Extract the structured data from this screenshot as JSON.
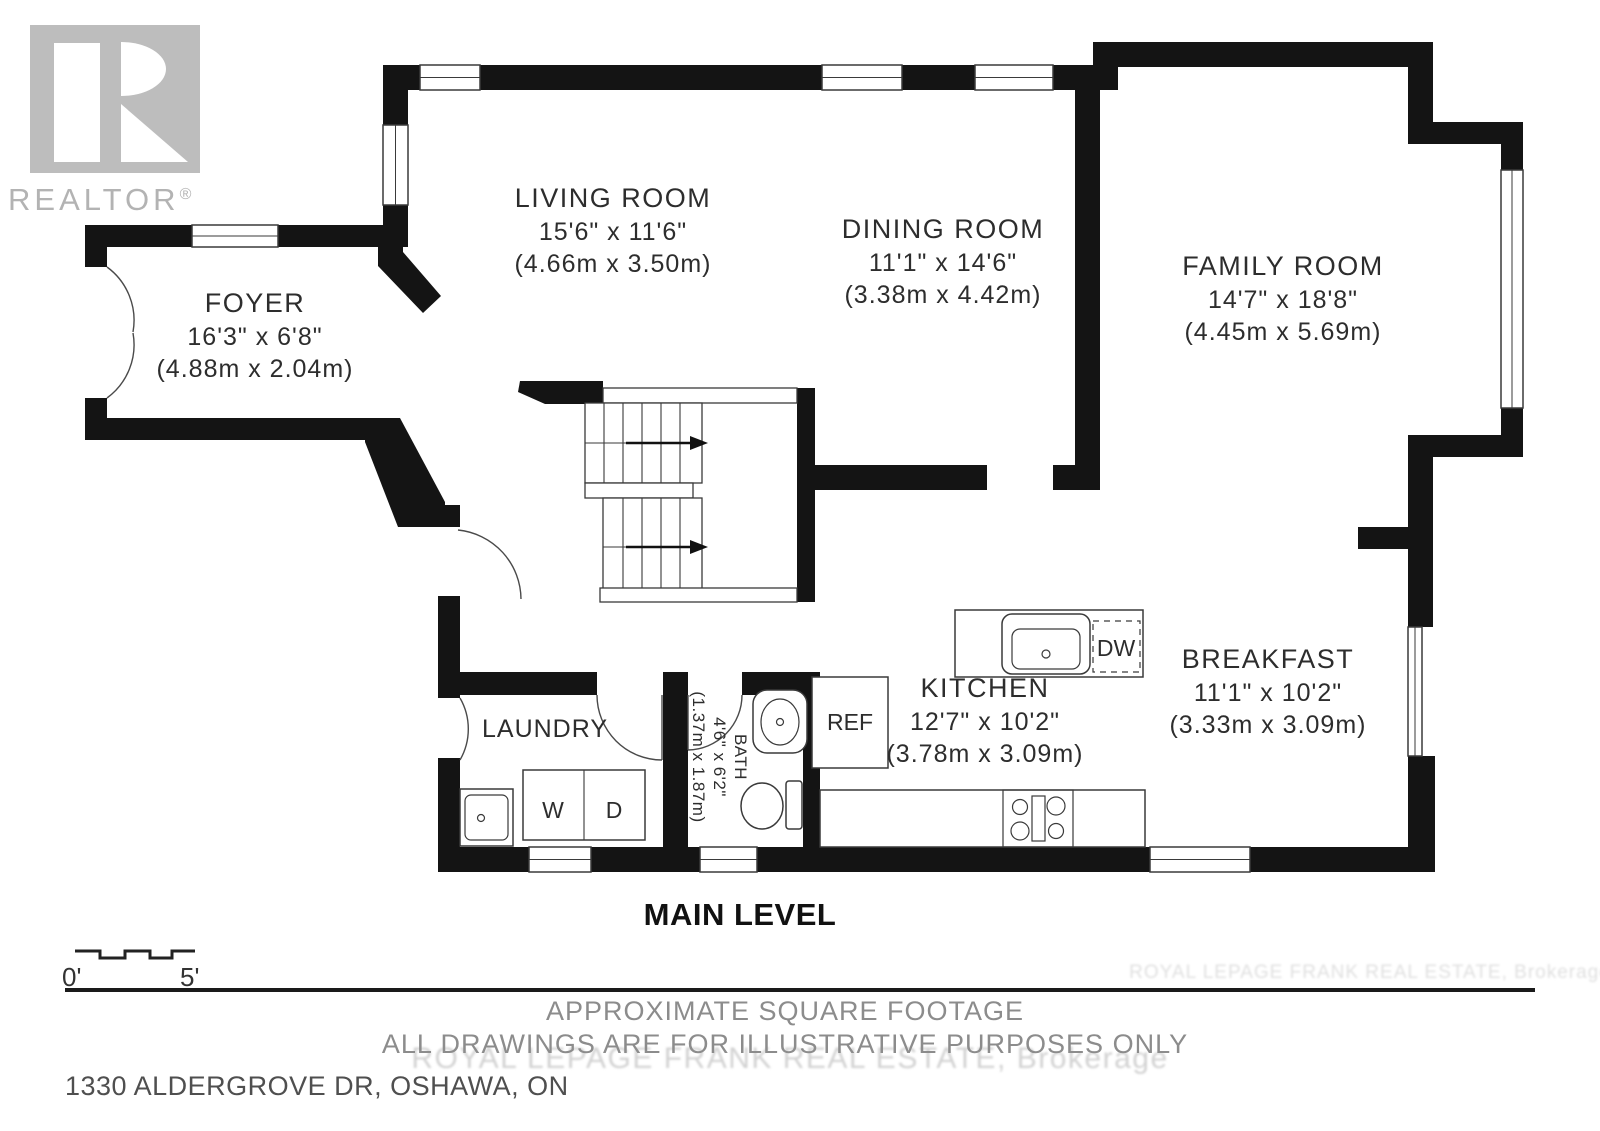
{
  "branding": {
    "realtor_wordmark": "REALTOR",
    "registered_mark": "®"
  },
  "rooms": {
    "living": {
      "name": "LIVING ROOM",
      "imperial": "15'6\" x 11'6\"",
      "metric": "(4.66m x 3.50m)"
    },
    "dining": {
      "name": "DINING ROOM",
      "imperial": "11'1\" x 14'6\"",
      "metric": "(3.38m x 4.42m)"
    },
    "family": {
      "name": "FAMILY ROOM",
      "imperial": "14'7\" x 18'8\"",
      "metric": "(4.45m x 5.69m)"
    },
    "foyer": {
      "name": "FOYER",
      "imperial": "16'3\" x 6'8\"",
      "metric": "(4.88m x 2.04m)"
    },
    "kitchen": {
      "name": "KITCHEN",
      "imperial": "12'7\" x 10'2\"",
      "metric": "(3.78m x 3.09m)"
    },
    "breakfast": {
      "name": "BREAKFAST",
      "imperial": "11'1\" x 10'2\"",
      "metric": "(3.33m x 3.09m)"
    },
    "laundry": {
      "name": "LAUNDRY"
    },
    "bath": {
      "name": "BATH",
      "imperial": "4'6\" x 6'2\"",
      "metric": "(1.37m x 1.87m)"
    }
  },
  "appliances": {
    "washer": "W",
    "dryer": "D",
    "dishwasher": "DW",
    "refrigerator": "REF"
  },
  "titles": {
    "level": "MAIN LEVEL"
  },
  "scale_bar": {
    "start_label": "0'",
    "end_label": "5'"
  },
  "footer": {
    "note_line1": "APPROXIMATE SQUARE FOOTAGE",
    "note_line2": "ALL DRAWINGS ARE FOR ILLUSTRATIVE PURPOSES ONLY",
    "address": "1330 ALDERGROVE DR, OSHAWA, ON",
    "watermark": "ROYAL LEPAGE FRANK REAL ESTATE, Brokerage"
  },
  "colors": {
    "wall": "#141414",
    "room_text": "#2d2d2d",
    "muted_text": "#8c8c8c",
    "address_text": "#4f4f4f",
    "logo_gray": "#bdbdbd",
    "watermark_gray": "#d2d2d2"
  }
}
